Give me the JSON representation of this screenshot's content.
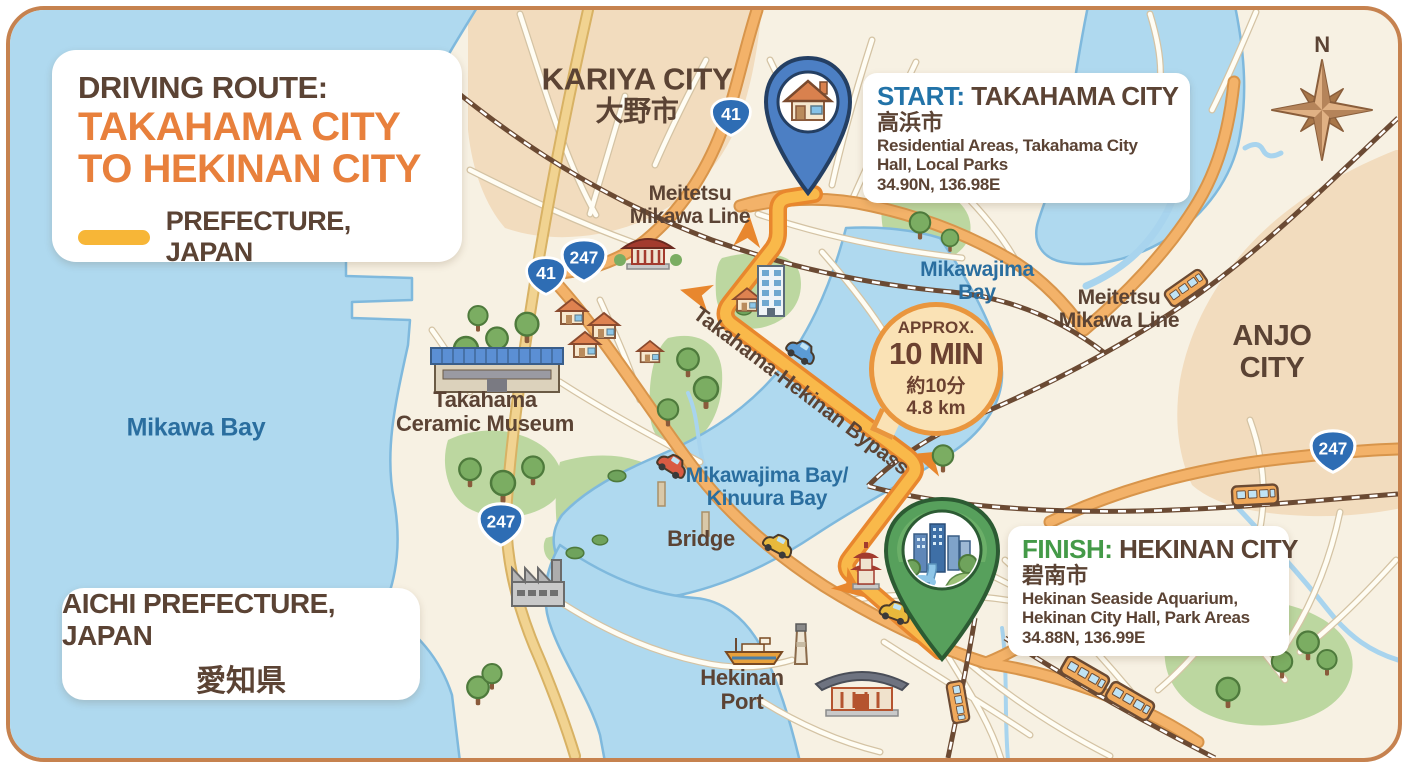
{
  "title_card": {
    "heading": "DRIVING ROUTE:",
    "line1": "TAKAHAMA CITY",
    "line2": "TO HEKINAN CITY",
    "legend_label": "PREFECTURE, JAPAN"
  },
  "start_card": {
    "prefix": "START:",
    "name": "TAKAHAMA CITY",
    "name_jp": "高浜市",
    "description": "Residential Areas, Takahama City Hall, Local Parks",
    "coordinates": "34.90N, 136.98E"
  },
  "finish_card": {
    "prefix": "FINISH:",
    "name": "HEKINAN CITY",
    "name_jp": "碧南市",
    "description": "Hekinan Seaside Aquarium, Hekinan City Hall, Park Areas",
    "coordinates": "34.88N, 136.99E"
  },
  "region_card": {
    "line1": "AICHI PREFECTURE, JAPAN",
    "line2": "愛知県"
  },
  "time_badge": {
    "approx": "APPROX.",
    "duration": "10 MIN",
    "duration_jp": "約10分",
    "distance": "4.8 km"
  },
  "labels": {
    "kariya_en": "KARIYA CITY",
    "kariya_jp": "大野市",
    "meitetsu_l1": "Meitetsu",
    "meitetsu_l2": "Mikawa Line",
    "mikawajima_l1": "Mikawajima",
    "mikawajima_l2": "Bay",
    "anjo_l1": "ANJO",
    "anjo_l2": "CITY",
    "museum_l1": "Takahama",
    "museum_l2": "Ceramic Museum",
    "mikawa_bay": "Mikawa Bay",
    "kinuura_l1": "Mikawajima Bay/",
    "kinuura_l2": "Kinuura Bay",
    "bridge": "Bridge",
    "bypass": "Takahama-Hekinan Bypass",
    "hekinan_port_l1": "Hekinan",
    "hekinan_port_l2": "Port",
    "compass_n": "N"
  },
  "shields": [
    "41",
    "247",
    "41",
    "247",
    "247"
  ],
  "colors": {
    "route": "#F9B94A",
    "route_casing": "#E8872E",
    "water": "#AFD9EF",
    "land": "#F7F1E3",
    "city_area": "#F2DCBE",
    "park": "#BCD7A0",
    "title_accent": "#E8803C",
    "start_accent": "#2273A8",
    "finish_accent": "#449A48",
    "shield_blue": "#2E6DB4",
    "text_brown": "#5B4334",
    "text_blue": "#2A6E9F"
  }
}
